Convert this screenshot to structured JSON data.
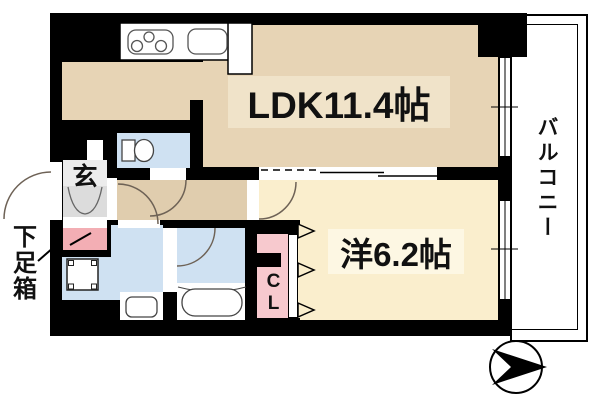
{
  "plan": {
    "labels": {
      "ldk": "LDK11.4帖",
      "bedroom": "洋6.2帖",
      "balcony": "バルコニー",
      "entrance": "玄",
      "shoe_box": "下足箱",
      "closet": "CL"
    },
    "colors": {
      "wall": "#000000",
      "ldk_floor": "#e7d4b5",
      "hall_floor": "#e0cdae",
      "bedroom_floor": "#faeecd",
      "wet_floor": "#cfe1f2",
      "closet_pink": "#f7c9ce",
      "accent_pink": "#f3aeb4",
      "genkan_gray": "#ececec",
      "genkan_step": "#dcdcdc",
      "band_ldk": "#f0e3c9",
      "band_bedroom": "#fdf7e3"
    },
    "icons": {
      "stove": "stove-3-burner-icon",
      "kitchen_sink": "kitchen-sink-icon",
      "toilet": "toilet-icon",
      "washing_machine": "washing-machine-icon",
      "washbasin": "washbasin-icon",
      "bathtub": "bathtub-icon",
      "compass": "direction-arrow-icon"
    }
  }
}
